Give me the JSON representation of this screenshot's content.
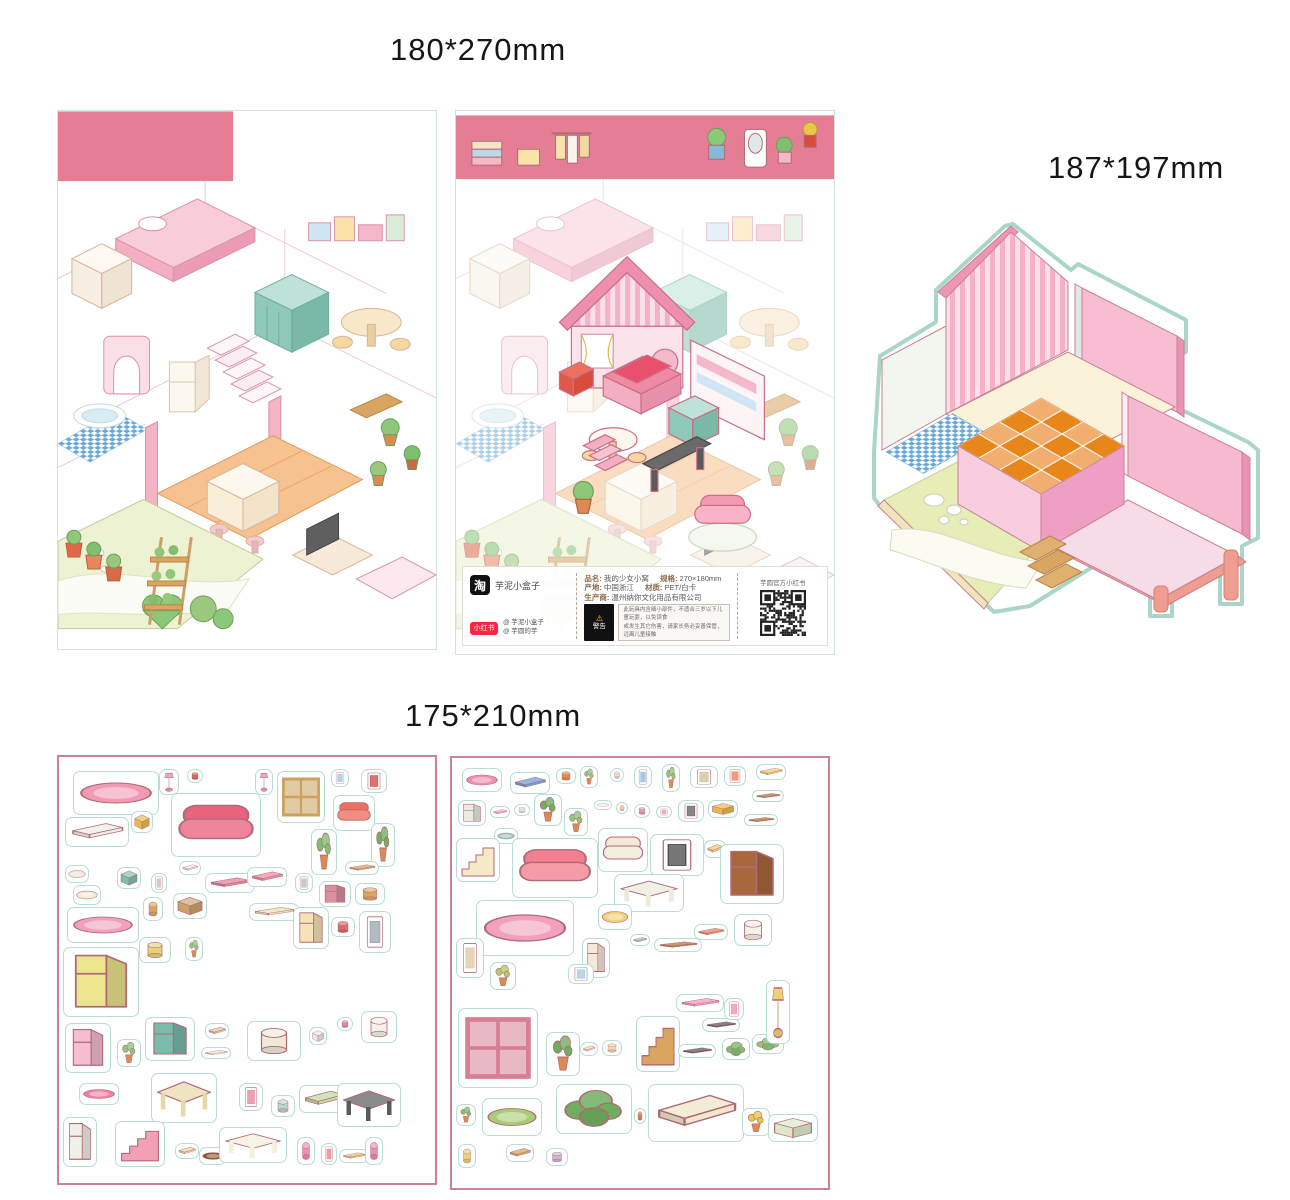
{
  "labels": {
    "posters_size": "180*270mm",
    "base_size": "187*197mm",
    "sheets_size": "175*210mm"
  },
  "colors": {
    "band_pink": "#e57e95",
    "sheet_border": "#cc8391",
    "diecut_outline": "#a9d6c9",
    "tile_orange": "#e8861a",
    "tile_blue": "#66a9d8",
    "wall_pink": "#f5b1c8"
  },
  "info_bar": {
    "taobao_logo": "淘",
    "shop_name": "芋泥小盒子",
    "xhs_logo": "小红书",
    "xhs_accounts": [
      "@ 芋泥小盒子",
      "@ 芋圆的芋"
    ],
    "product_fields": [
      {
        "label": "品名:",
        "value": "我的少女小窝"
      },
      {
        "label": "规格:",
        "value": "270×180mm"
      },
      {
        "label": "产地:",
        "value": "中国浙江"
      },
      {
        "label": "材质:",
        "value": "PET/白卡"
      },
      {
        "label": "生产商:",
        "value": "温州纳你文化用品有限公司"
      }
    ],
    "warning_title": "警告",
    "warning_lines": [
      "此玩具内含细小部件，不适合三岁以下儿童玩耍，以免误食",
      "或发生其它伤害，请家长务必妥善保管，远离儿童接触"
    ],
    "qr_caption": "芋圆官方小红书"
  },
  "stickers": {
    "format": "x,y,w,h,shape,color,name",
    "sheet1": [
      [
        14,
        14,
        86,
        44,
        "rug",
        "#f29ab4",
        "rug"
      ],
      [
        100,
        12,
        20,
        26,
        "lamp",
        "#eba7bb",
        "table-lamp"
      ],
      [
        128,
        12,
        16,
        14,
        "round",
        "#e06060",
        "bowl"
      ],
      [
        112,
        36,
        90,
        64,
        "sofa",
        "#e8637e",
        "bed"
      ],
      [
        196,
        12,
        18,
        26,
        "lamp",
        "#eba7bb",
        "table-lamp"
      ],
      [
        218,
        14,
        48,
        52,
        "window",
        "#caa25c",
        "window"
      ],
      [
        272,
        12,
        18,
        18,
        "frame",
        "#98c8e0",
        "picture-frame"
      ],
      [
        302,
        12,
        26,
        24,
        "frame",
        "#d04848",
        "picture-frame"
      ],
      [
        274,
        38,
        42,
        36,
        "sofa",
        "#ee6f5d",
        "armchair"
      ],
      [
        6,
        60,
        64,
        30,
        "slab",
        "#efede4",
        "wall-shelf"
      ],
      [
        72,
        54,
        22,
        22,
        "box",
        "#e8b84a",
        "storage-box"
      ],
      [
        252,
        72,
        26,
        46,
        "plant",
        "#7fbf6f",
        "potted-plant"
      ],
      [
        312,
        66,
        24,
        44,
        "plant",
        "#6fae5f",
        "potted-plant"
      ],
      [
        286,
        104,
        34,
        14,
        "slab",
        "#d9a662",
        "shelf-board"
      ],
      [
        6,
        108,
        24,
        18,
        "rug",
        "#efe6d4",
        "cushion"
      ],
      [
        58,
        110,
        24,
        22,
        "box",
        "#7ac0b0",
        "crate"
      ],
      [
        92,
        116,
        16,
        20,
        "frame",
        "#c8bfa8",
        "small-frame"
      ],
      [
        120,
        104,
        22,
        14,
        "slab",
        "#efefe8",
        "slippers"
      ],
      [
        146,
        116,
        50,
        20,
        "slab",
        "#e87f9a",
        "book-shelf"
      ],
      [
        188,
        110,
        40,
        20,
        "slab",
        "#ef8fa5",
        "tray"
      ],
      [
        236,
        116,
        18,
        20,
        "frame",
        "#b8b8b0",
        "outlet"
      ],
      [
        260,
        124,
        32,
        26,
        "tall",
        "#d88f9f",
        "mini-bookcase"
      ],
      [
        296,
        126,
        30,
        22,
        "round",
        "#d9a662",
        "basket"
      ],
      [
        14,
        128,
        28,
        20,
        "rug",
        "#f2ead8",
        "cloud-rug"
      ],
      [
        84,
        140,
        20,
        24,
        "round",
        "#d9a662",
        "stool"
      ],
      [
        114,
        136,
        34,
        26,
        "box",
        "#caa26a",
        "crate"
      ],
      [
        8,
        150,
        72,
        36,
        "rug",
        "#f2a0bc",
        "oval-rug"
      ],
      [
        190,
        146,
        50,
        18,
        "slab",
        "#efe0b8",
        "bench"
      ],
      [
        234,
        150,
        36,
        42,
        "tall",
        "#f5e2b8",
        "wardrobe-rack"
      ],
      [
        272,
        160,
        24,
        20,
        "round",
        "#e06868",
        "flower-pot"
      ],
      [
        300,
        154,
        32,
        42,
        "frame",
        "#9aa4ac",
        "mirror"
      ],
      [
        80,
        180,
        32,
        26,
        "round",
        "#e8d478",
        "ottoman"
      ],
      [
        126,
        180,
        18,
        24,
        "plant",
        "#8cc878",
        "potted-plant"
      ],
      [
        4,
        190,
        76,
        70,
        "tall",
        "#ede48e",
        "shelf-unit"
      ],
      [
        6,
        266,
        46,
        50,
        "tall",
        "#f4bed0",
        "vanity"
      ],
      [
        58,
        282,
        24,
        28,
        "plant",
        "#8cc878",
        "potted-plant"
      ],
      [
        86,
        260,
        50,
        44,
        "tall",
        "#79bcab",
        "radiator-cabinet"
      ],
      [
        146,
        266,
        24,
        16,
        "slab",
        "#e8c8a0",
        "tray"
      ],
      [
        142,
        290,
        30,
        12,
        "slab",
        "#efe8d8",
        "board"
      ],
      [
        188,
        264,
        54,
        40,
        "round",
        "#f2ead8",
        "corner-bathtub"
      ],
      [
        250,
        270,
        18,
        18,
        "box",
        "#e8e8e0",
        "tissue-box"
      ],
      [
        278,
        260,
        16,
        14,
        "round",
        "#d88f9f",
        "cup"
      ],
      [
        302,
        254,
        36,
        32,
        "round",
        "#f5f0e8",
        "toilet"
      ],
      [
        20,
        326,
        40,
        22,
        "rug",
        "#ef7f9f",
        "half-rug"
      ],
      [
        92,
        316,
        66,
        50,
        "table",
        "#e8d8a8",
        "dining-set"
      ],
      [
        180,
        326,
        24,
        28,
        "frame",
        "#e87f9a",
        "heart-frame"
      ],
      [
        212,
        338,
        24,
        22,
        "round",
        "#b8d8c8",
        "bucket"
      ],
      [
        240,
        328,
        50,
        28,
        "slab",
        "#c8dc9f",
        "bench"
      ],
      [
        278,
        326,
        64,
        44,
        "table",
        "#5a5a5a",
        "desk"
      ],
      [
        4,
        360,
        34,
        50,
        "tall",
        "#f2f0ea",
        "fridge"
      ],
      [
        56,
        364,
        50,
        46,
        "stairs",
        "#f2a0b8",
        "staircase"
      ],
      [
        116,
        386,
        24,
        16,
        "slab",
        "#f0d8a8",
        "mat"
      ],
      [
        140,
        390,
        28,
        18,
        "rug",
        "#8a5a32",
        "doormat"
      ],
      [
        160,
        370,
        68,
        36,
        "table",
        "#f5efdd",
        "tv-stand"
      ],
      [
        238,
        380,
        18,
        28,
        "round",
        "#ef8fa5",
        "bar-stool"
      ],
      [
        262,
        386,
        16,
        22,
        "frame",
        "#e87f7f",
        "small-frame"
      ],
      [
        280,
        392,
        30,
        14,
        "slab",
        "#e8c878",
        "board"
      ],
      [
        306,
        380,
        18,
        28,
        "round",
        "#ef8fa5",
        "bar-stool"
      ]
    ],
    "sheet2": [
      [
        10,
        10,
        40,
        24,
        "rug",
        "#ef8fad",
        "rug"
      ],
      [
        58,
        14,
        40,
        22,
        "slab",
        "#6f9fd8",
        "tray"
      ],
      [
        104,
        10,
        20,
        16,
        "round",
        "#e08a4e",
        "food-plate"
      ],
      [
        128,
        8,
        18,
        22,
        "plant",
        "#8cc878",
        "potted-plant"
      ],
      [
        158,
        10,
        14,
        14,
        "round",
        "#e8e0d0",
        "cup"
      ],
      [
        182,
        8,
        18,
        22,
        "frame",
        "#88b8e0",
        "picture-frame"
      ],
      [
        210,
        6,
        18,
        28,
        "plant",
        "#8cc878",
        "potted-plant"
      ],
      [
        238,
        8,
        28,
        22,
        "frame",
        "#d0c090",
        "wall-panel"
      ],
      [
        272,
        8,
        22,
        20,
        "frame",
        "#e87f56",
        "clock"
      ],
      [
        304,
        6,
        30,
        16,
        "slab",
        "#f0d078",
        "shelf-board"
      ],
      [
        300,
        32,
        32,
        12,
        "slab",
        "#b07840",
        "shelf-board"
      ],
      [
        6,
        42,
        28,
        26,
        "tall",
        "#eceae2",
        "coffee-machine"
      ],
      [
        38,
        48,
        20,
        12,
        "slab",
        "#f2b8c8",
        "switch-plate"
      ],
      [
        62,
        46,
        16,
        12,
        "round",
        "#e8e8e0",
        "plate"
      ],
      [
        82,
        36,
        28,
        32,
        "plant",
        "#6fae5f",
        "potted-plant"
      ],
      [
        112,
        50,
        24,
        28,
        "plant",
        "#8cc878",
        "potted-plant"
      ],
      [
        142,
        42,
        18,
        10,
        "rug",
        "#efefe8",
        "dish"
      ],
      [
        164,
        44,
        12,
        12,
        "round",
        "#e8d0c0",
        "cup"
      ],
      [
        182,
        46,
        16,
        14,
        "round",
        "#d8a0b0",
        "teapot"
      ],
      [
        204,
        48,
        16,
        12,
        "frame",
        "#ef8fa5",
        "small-frame"
      ],
      [
        226,
        42,
        26,
        22,
        "frame",
        "#606060",
        "dark-frame"
      ],
      [
        256,
        42,
        30,
        18,
        "box",
        "#e8b84a",
        "storage-shelf"
      ],
      [
        292,
        56,
        34,
        12,
        "slab",
        "#b07840",
        "shelf-board"
      ],
      [
        42,
        70,
        24,
        16,
        "rug",
        "#9fc8b8",
        "pet-bed"
      ],
      [
        4,
        80,
        44,
        44,
        "stairs",
        "#f5e9c8",
        "staircase"
      ],
      [
        60,
        80,
        86,
        60,
        "sofa",
        "#f28090",
        "sofa"
      ],
      [
        146,
        70,
        50,
        44,
        "sofa",
        "#f2ead8",
        "armchair"
      ],
      [
        198,
        76,
        54,
        42,
        "frame",
        "#4a4a4a",
        "tv"
      ],
      [
        252,
        82,
        22,
        18,
        "slab",
        "#f0d078",
        "cushion"
      ],
      [
        268,
        86,
        64,
        60,
        "tall",
        "#a9683c",
        "bunk-shelf"
      ],
      [
        162,
        116,
        70,
        38,
        "table",
        "#eceada",
        "tv-cabinet"
      ],
      [
        24,
        142,
        98,
        56,
        "rug",
        "#f2a0bc",
        "oval-rug"
      ],
      [
        146,
        146,
        34,
        26,
        "rug",
        "#f0d078",
        "blanket"
      ],
      [
        130,
        180,
        28,
        40,
        "tall",
        "#f5e8d8",
        "doll-figure"
      ],
      [
        178,
        176,
        20,
        12,
        "slab",
        "#9fc8b8",
        "tray"
      ],
      [
        202,
        180,
        48,
        14,
        "slab",
        "#b07840",
        "shelf-board"
      ],
      [
        242,
        166,
        34,
        16,
        "slab",
        "#e08a6e",
        "board"
      ],
      [
        282,
        156,
        38,
        32,
        "round",
        "#f5f0e8",
        "side-table"
      ],
      [
        4,
        180,
        28,
        40,
        "frame",
        "#e0c8a0",
        "wall-shelf"
      ],
      [
        38,
        204,
        26,
        28,
        "plant",
        "#b8c86f",
        "flowers"
      ],
      [
        116,
        206,
        26,
        20,
        "frame",
        "#a8c8e0",
        "picture-frame"
      ],
      [
        6,
        250,
        80,
        80,
        "window",
        "#d87f96",
        "window-panel"
      ],
      [
        94,
        274,
        34,
        44,
        "plant",
        "#6fae5f",
        "potted-plant"
      ],
      [
        128,
        284,
        18,
        14,
        "slab",
        "#f2d8b8",
        "envelope"
      ],
      [
        150,
        282,
        20,
        16,
        "round",
        "#f0d8a8",
        "bread"
      ],
      [
        184,
        258,
        44,
        56,
        "stairs",
        "#d9a662",
        "ladder-shelf"
      ],
      [
        226,
        286,
        38,
        14,
        "slab",
        "#5a5a5a",
        "shelf-board"
      ],
      [
        250,
        260,
        38,
        14,
        "slab",
        "#5a5a5a",
        "shelf-board"
      ],
      [
        270,
        280,
        28,
        22,
        "green",
        "#7fbf6f",
        "hanging-plant"
      ],
      [
        300,
        276,
        32,
        20,
        "green",
        "#8cc878",
        "cacti"
      ],
      [
        314,
        222,
        24,
        64,
        "lamp",
        "#f0d078",
        "floor-lamp"
      ],
      [
        224,
        236,
        48,
        18,
        "slab",
        "#f2a0bc",
        "coat-rack"
      ],
      [
        272,
        240,
        20,
        22,
        "frame",
        "#ef8fa5",
        "picture-frame"
      ],
      [
        30,
        340,
        60,
        38,
        "rug",
        "#a8cc74",
        "pond-rug"
      ],
      [
        4,
        346,
        20,
        22,
        "plant",
        "#7fbf6f",
        "cactus"
      ],
      [
        104,
        326,
        76,
        50,
        "green",
        "#6fae5f",
        "bushes"
      ],
      [
        182,
        350,
        12,
        16,
        "round",
        "#d87f56",
        "bottle"
      ],
      [
        196,
        326,
        96,
        58,
        "slab",
        "#f0e8cc",
        "path-piece"
      ],
      [
        290,
        350,
        28,
        28,
        "plant",
        "#e8c84a",
        "flower-pot"
      ],
      [
        316,
        356,
        50,
        28,
        "box",
        "#dce8c8",
        "planter-box"
      ],
      [
        6,
        386,
        18,
        24,
        "round",
        "#e8d478",
        "jar"
      ],
      [
        54,
        386,
        28,
        18,
        "slab",
        "#d9a662",
        "board"
      ],
      [
        94,
        390,
        22,
        18,
        "round",
        "#c8b8d8",
        "pot"
      ]
    ]
  }
}
